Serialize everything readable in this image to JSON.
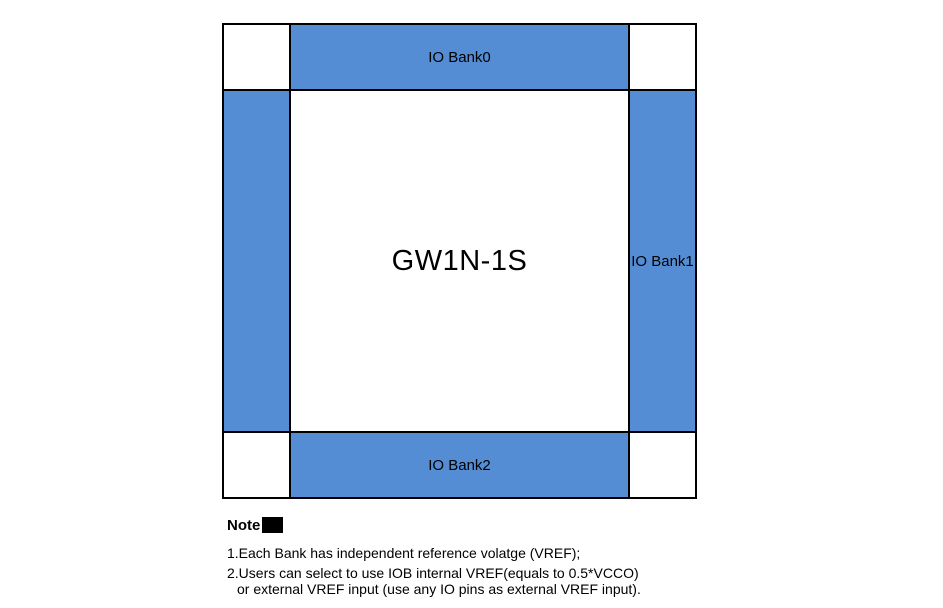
{
  "figure": {
    "chip_name": "GW1N-1S",
    "banks": {
      "top": {
        "label": "IO Bank0"
      },
      "right": {
        "label": "IO Bank1"
      },
      "bottom": {
        "label": "IO Bank2"
      },
      "left": {
        "label": ""
      }
    },
    "colors": {
      "bank_fill": "#548DD4",
      "line": "#000000",
      "background": "#FFFFFF"
    }
  },
  "notes": {
    "heading": "Note",
    "items": [
      {
        "lines": [
          "1.Each Bank has independent reference volatge (VREF);"
        ]
      },
      {
        "lines": [
          "2.Users can select to use IOB internal VREF(equals to 0.5*VCCO)",
          "or external VREF input (use any IO pins as external VREF input)."
        ]
      }
    ]
  }
}
